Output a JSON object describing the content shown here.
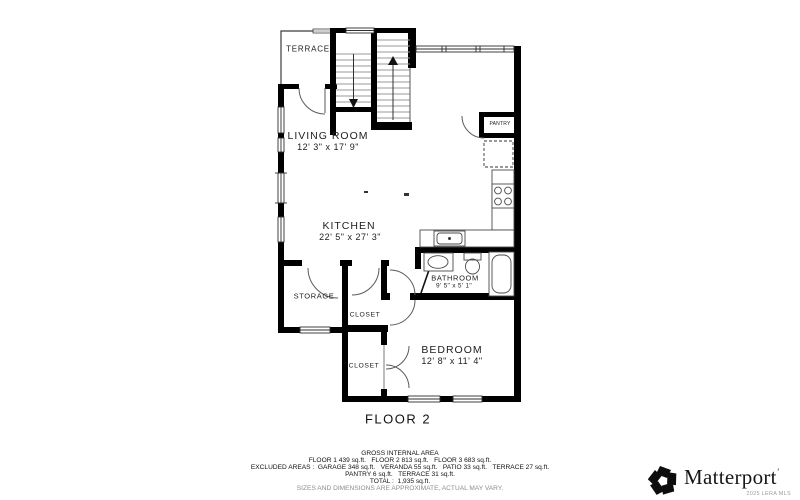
{
  "floor_plan": {
    "floor_label": "FLOOR 2",
    "rooms": {
      "terrace": {
        "name": "TERRACE"
      },
      "living_room": {
        "name": "LIVING ROOM",
        "dims": "12' 3\" x 17' 9\""
      },
      "kitchen": {
        "name": "KITCHEN",
        "dims": "22' 5\" x 27' 3\""
      },
      "pantry": {
        "name": "PANTRY"
      },
      "storage": {
        "name": "STORAGE"
      },
      "closet_upper": {
        "name": "CLOSET"
      },
      "closet_lower": {
        "name": "CLOSET"
      },
      "bathroom": {
        "name": "BATHROOM",
        "dims": "9' 5\" x 5' 1\""
      },
      "bedroom": {
        "name": "BEDROOM",
        "dims": "12' 8\" x 11' 4\""
      }
    }
  },
  "area_summary": {
    "title": "GROSS INTERNAL AREA",
    "line_floors": "FLOOR 1 439 sq.ft.   FLOOR 2 813 sq.ft.   FLOOR 3 683 sq.ft.",
    "line_excluded": "EXCLUDED AREAS :  GARAGE 348 sq.ft.   VERANDA 55 sq.ft.   PATIO 33 sq.ft.   TERRACE 27 sq.ft.",
    "line_excluded2": "PANTRY 6 sq.ft.   TERRACE 31 sq.ft.",
    "line_total": "TOTAL :  1,935 sq.ft.",
    "disclaimer": "SIZES AND DIMENSIONS ARE APPROXIMATE, ACTUAL MAY VARY."
  },
  "branding": {
    "logo_text": "Matterport",
    "trademark_mark": "’",
    "attribution": "2025 LERA MLS"
  },
  "colors": {
    "walls": "#000000",
    "label_text": "#1d1d1d",
    "muted_text": "#8d8d8d",
    "attribution_text": "#9a9a9a"
  }
}
